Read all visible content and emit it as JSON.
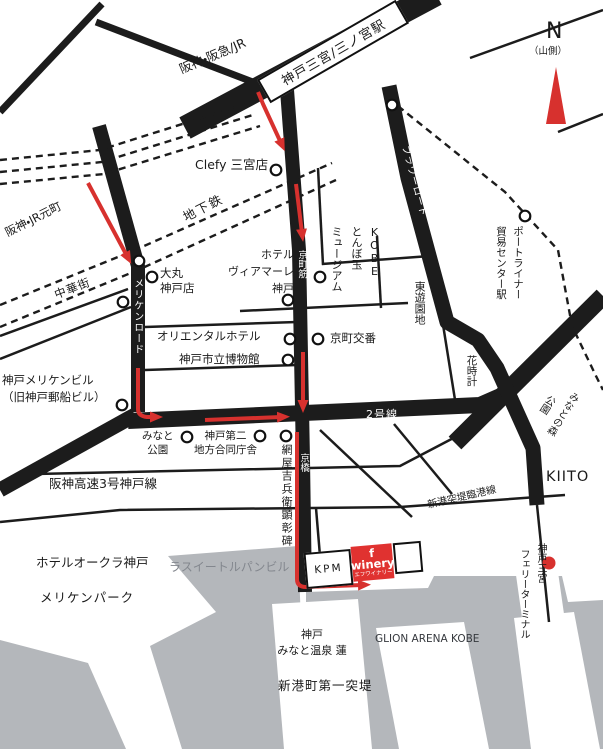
{
  "compass": {
    "label": "N",
    "note": "（山側）"
  },
  "station": {
    "name": "神戸三宮/三ノ宮駅",
    "lines_label": "阪神・阪急/JR"
  },
  "roads": {
    "kyomachisuji": "京町筋",
    "flower_road": "フラワーロード",
    "meriken_road": "メリケンロード",
    "route2": "2号線",
    "to_osaka": "至大阪",
    "to_akashi": "至明石",
    "hanshin_expwy": "阪神高速3号神戸線",
    "kyobashi": "京橋",
    "rinkosen": "新港突堤臨港線",
    "chinatown": "中華街",
    "subway": "地下鉄",
    "motomachi": "阪神・JR元町"
  },
  "labels": {
    "clefy": "Clefy 三宮店",
    "daimaru": "大丸\n神戸店",
    "viamare": "ホテル\nヴィアマーレ\n神戸",
    "tonbodama_cols": [
      "ミュージアム",
      "とんぼ玉",
      "KOBE"
    ],
    "kyomachi_koban": "京町交番",
    "higashi_yuenchi": "東遊園地",
    "oriental_hotel": "オリエンタルホテル",
    "city_museum": "神戸市立博物館",
    "portliner_cols": [
      "貿易センター駅",
      "ポートライナー"
    ],
    "hanadokei": "花時計",
    "minatonomori_cols": [
      "公園",
      "みなとの森"
    ],
    "meriken_bldg": "神戸メリケンビル\n（旧神戸郵船ビル）",
    "minato_park": "みなと\n公園",
    "godochosha": "神戸第二\n地方合同庁舎",
    "amiya": "網屋吉兵衛顕彰碑",
    "kiito": "KIITO",
    "ferry_cols": [
      "フェリーターミナル",
      "神戸三宮"
    ],
    "hotel_okura": "ホテルオークラ神戸",
    "meriken_park": "メリケンパーク",
    "lasuite": "ラスイートルパンビル",
    "kpm": "KPM",
    "fwinery_name": "f winery",
    "fwinery_kana": "エフワイナリー",
    "onsen": "神戸\nみなと温泉 蓮",
    "shinko_pier": "新港町第一突堤",
    "glion": "GLION ARENA KOBE"
  },
  "colors": {
    "road": "#1c1c1c",
    "water": "#b4b7bb",
    "route_red": "#d7312e",
    "winery_red": "#e03230",
    "gray_text": "#83878e"
  }
}
